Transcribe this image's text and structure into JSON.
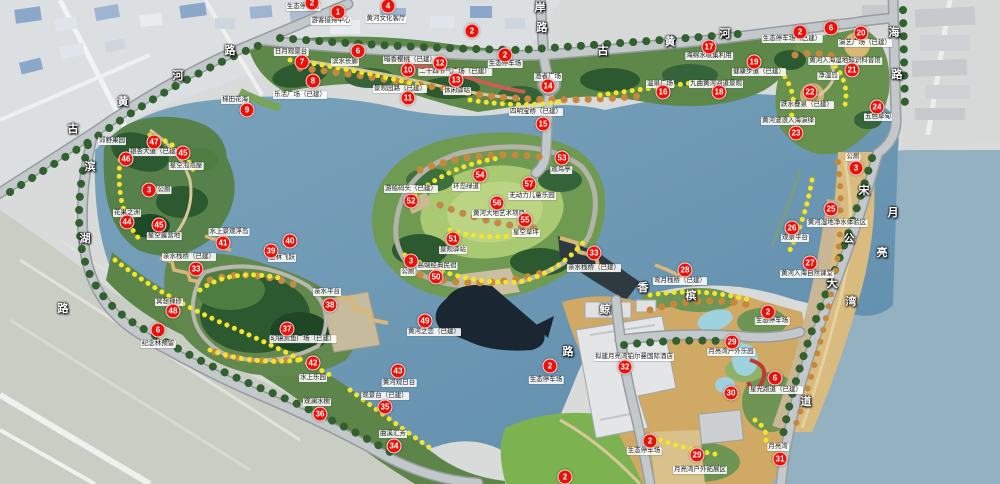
{
  "palette": {
    "water": "#6d98b4",
    "park_green": "#5e874a",
    "forest_green": "#2d5930",
    "lawn_green": "#7cb24f",
    "road_gray": "#c3c8cb",
    "resort_tan": "#d0a965",
    "beach_sand": "#dabb7f",
    "marker_red": "#e8120b",
    "flower_yellow": "#f3e42c"
  },
  "markers": [
    {
      "n": "1",
      "x": 338,
      "y": 12
    },
    {
      "n": "2",
      "x": 312,
      "y": 3
    },
    {
      "n": "4",
      "x": 388,
      "y": 6
    },
    {
      "n": "2",
      "x": 472,
      "y": 31
    },
    {
      "n": "2",
      "x": 505,
      "y": 55
    },
    {
      "n": "6",
      "x": 358,
      "y": 51
    },
    {
      "n": "7",
      "x": 302,
      "y": 62
    },
    {
      "n": "8",
      "x": 313,
      "y": 81
    },
    {
      "n": "9",
      "x": 247,
      "y": 110
    },
    {
      "n": "10",
      "x": 408,
      "y": 70
    },
    {
      "n": "12",
      "x": 440,
      "y": 63
    },
    {
      "n": "11",
      "x": 408,
      "y": 98
    },
    {
      "n": "13",
      "x": 456,
      "y": 80
    },
    {
      "n": "14",
      "x": 548,
      "y": 86
    },
    {
      "n": "15",
      "x": 543,
      "y": 124
    },
    {
      "n": "2",
      "x": 800,
      "y": 32
    },
    {
      "n": "6",
      "x": 831,
      "y": 28
    },
    {
      "n": "20",
      "x": 861,
      "y": 33
    },
    {
      "n": "21",
      "x": 852,
      "y": 70
    },
    {
      "n": "17",
      "x": 709,
      "y": 47
    },
    {
      "n": "19",
      "x": 754,
      "y": 62
    },
    {
      "n": "16",
      "x": 663,
      "y": 92
    },
    {
      "n": "18",
      "x": 719,
      "y": 92
    },
    {
      "n": "22",
      "x": 810,
      "y": 92
    },
    {
      "n": "24",
      "x": 877,
      "y": 107
    },
    {
      "n": "23",
      "x": 796,
      "y": 133
    },
    {
      "n": "3",
      "x": 856,
      "y": 168
    },
    {
      "n": "25",
      "x": 831,
      "y": 209
    },
    {
      "n": "26",
      "x": 792,
      "y": 228
    },
    {
      "n": "27",
      "x": 810,
      "y": 263
    },
    {
      "n": "28",
      "x": 685,
      "y": 270
    },
    {
      "n": "33",
      "x": 594,
      "y": 253
    },
    {
      "n": "2",
      "x": 768,
      "y": 312
    },
    {
      "n": "29",
      "x": 732,
      "y": 342
    },
    {
      "n": "32",
      "x": 625,
      "y": 367
    },
    {
      "n": "6",
      "x": 775,
      "y": 378
    },
    {
      "n": "30",
      "x": 731,
      "y": 393
    },
    {
      "n": "2",
      "x": 550,
      "y": 366
    },
    {
      "n": "2",
      "x": 650,
      "y": 441
    },
    {
      "n": "29",
      "x": 697,
      "y": 455
    },
    {
      "n": "31",
      "x": 780,
      "y": 459
    },
    {
      "n": "2",
      "x": 565,
      "y": 477
    },
    {
      "n": "53",
      "x": 562,
      "y": 158
    },
    {
      "n": "54",
      "x": 480,
      "y": 175
    },
    {
      "n": "57",
      "x": 529,
      "y": 184
    },
    {
      "n": "56",
      "x": 497,
      "y": 203
    },
    {
      "n": "55",
      "x": 525,
      "y": 220
    },
    {
      "n": "52",
      "x": 411,
      "y": 201
    },
    {
      "n": "51",
      "x": 453,
      "y": 239
    },
    {
      "n": "3",
      "x": 411,
      "y": 261
    },
    {
      "n": "50",
      "x": 436,
      "y": 277
    },
    {
      "n": "49",
      "x": 425,
      "y": 321
    },
    {
      "n": "47",
      "x": 154,
      "y": 142
    },
    {
      "n": "45",
      "x": 183,
      "y": 153
    },
    {
      "n": "46",
      "x": 126,
      "y": 159
    },
    {
      "n": "3",
      "x": 149,
      "y": 190
    },
    {
      "n": "44",
      "x": 127,
      "y": 222
    },
    {
      "n": "45",
      "x": 159,
      "y": 225
    },
    {
      "n": "41",
      "x": 223,
      "y": 243
    },
    {
      "n": "40",
      "x": 290,
      "y": 241
    },
    {
      "n": "39",
      "x": 271,
      "y": 251
    },
    {
      "n": "33",
      "x": 196,
      "y": 269
    },
    {
      "n": "48",
      "x": 173,
      "y": 311
    },
    {
      "n": "6",
      "x": 158,
      "y": 330
    },
    {
      "n": "38",
      "x": 330,
      "y": 305
    },
    {
      "n": "37",
      "x": 287,
      "y": 329
    },
    {
      "n": "42",
      "x": 313,
      "y": 363
    },
    {
      "n": "43",
      "x": 398,
      "y": 371
    },
    {
      "n": "35",
      "x": 385,
      "y": 407
    },
    {
      "n": "36",
      "x": 320,
      "y": 414
    },
    {
      "n": "34",
      "x": 394,
      "y": 446
    }
  ],
  "labels": [
    {
      "text": "生态停车场",
      "x": 303,
      "y": 7
    },
    {
      "text": "游客接待中心",
      "x": 331,
      "y": 21
    },
    {
      "text": "黄河文化客厅",
      "x": 386,
      "y": 19
    },
    {
      "text": "滨水长廊",
      "x": 345,
      "y": 62
    },
    {
      "text": "日月观景台",
      "x": 291,
      "y": 52
    },
    {
      "text": "乐活广场（已建）",
      "x": 300,
      "y": 95
    },
    {
      "text": "梯田花海",
      "x": 235,
      "y": 100
    },
    {
      "text": "暗香樱桃（已建）",
      "x": 410,
      "y": 60
    },
    {
      "text": "二十四节气广场（已建）",
      "x": 455,
      "y": 72
    },
    {
      "text": "景观园路（已建）",
      "x": 400,
      "y": 89
    },
    {
      "text": "休闲驿站",
      "x": 457,
      "y": 91
    },
    {
      "text": "生态停车场",
      "x": 505,
      "y": 64
    },
    {
      "text": "渔者广场",
      "x": 548,
      "y": 77
    },
    {
      "text": "四明宝桥（已建）",
      "x": 536,
      "y": 112
    },
    {
      "text": "生态停车场（已建）",
      "x": 792,
      "y": 39
    },
    {
      "text": "演艺广场（已建）",
      "x": 865,
      "y": 43
    },
    {
      "text": "黄河入海湿地知识科普馆",
      "x": 845,
      "y": 61
    },
    {
      "text": "净湿岛",
      "x": 828,
      "y": 76
    },
    {
      "text": "海绵水收集利用",
      "x": 709,
      "y": 56
    },
    {
      "text": "健康步道（已建）",
      "x": 759,
      "y": 72
    },
    {
      "text": "温泉广场",
      "x": 660,
      "y": 84
    },
    {
      "text": "九曲黄河河道景观",
      "x": 716,
      "y": 84
    },
    {
      "text": "跌水叠泉（已建）",
      "x": 807,
      "y": 105
    },
    {
      "text": "五色草甸",
      "x": 878,
      "y": 117
    },
    {
      "text": "黄河波浪入海演绎",
      "x": 788,
      "y": 121
    },
    {
      "text": "公厕",
      "x": 853,
      "y": 157
    },
    {
      "text": "黄河湿地净水体验区",
      "x": 837,
      "y": 223
    },
    {
      "text": "观景平台",
      "x": 795,
      "y": 238
    },
    {
      "text": "黄河入海自然课堂",
      "x": 807,
      "y": 274
    },
    {
      "text": "弯月栈桥（已建）",
      "x": 680,
      "y": 281
    },
    {
      "text": "郊野果园",
      "x": 112,
      "y": 141
    },
    {
      "text": "银杏大道（已建）",
      "x": 156,
      "y": 152
    },
    {
      "text": "星空泡泡屋",
      "x": 186,
      "y": 166
    },
    {
      "text": "公厕",
      "x": 164,
      "y": 190
    },
    {
      "text": "花果之洲",
      "x": 127,
      "y": 213
    },
    {
      "text": "星空露营地",
      "x": 164,
      "y": 236
    },
    {
      "text": "水上景观浮岛",
      "x": 229,
      "y": 232
    },
    {
      "text": "丛林飞跃",
      "x": 282,
      "y": 258
    },
    {
      "text": "亲水栈桥（已建）",
      "x": 189,
      "y": 257
    },
    {
      "text": "冥想禅修",
      "x": 169,
      "y": 302
    },
    {
      "text": "纪念林预留",
      "x": 158,
      "y": 344
    },
    {
      "text": "游船码头（已建）",
      "x": 411,
      "y": 189
    },
    {
      "text": "环岛绿道",
      "x": 466,
      "y": 187
    },
    {
      "text": "观鸟亭",
      "x": 561,
      "y": 170
    },
    {
      "text": "无动力儿童乐园",
      "x": 532,
      "y": 196
    },
    {
      "text": "黄河大地艺术项目",
      "x": 499,
      "y": 214
    },
    {
      "text": "星空草坪",
      "x": 526,
      "y": 233
    },
    {
      "text": "景观驿站",
      "x": 453,
      "y": 250
    },
    {
      "text": "公厕",
      "x": 408,
      "y": 272
    },
    {
      "text": "高端经典民宿",
      "x": 437,
      "y": 266
    },
    {
      "text": "黄河之恋（已建）",
      "x": 434,
      "y": 332
    },
    {
      "text": "亲水平台",
      "x": 327,
      "y": 292
    },
    {
      "text": "幻镜赏鱼广场（已建）",
      "x": 303,
      "y": 339
    },
    {
      "text": "水上乐园",
      "x": 313,
      "y": 378
    },
    {
      "text": "观澜水榭",
      "x": 317,
      "y": 402
    },
    {
      "text": "观景台（已建）",
      "x": 385,
      "y": 396
    },
    {
      "text": "曲溪汇芳",
      "x": 393,
      "y": 434
    },
    {
      "text": "黄河观日台",
      "x": 399,
      "y": 383
    },
    {
      "text": "亲水栈桥（已建）",
      "x": 594,
      "y": 268
    },
    {
      "text": "生态停车场",
      "x": 546,
      "y": 380
    },
    {
      "text": "拟建月亮湾铂尔曼国际酒店",
      "x": 634,
      "y": 357
    },
    {
      "text": "生态停车场",
      "x": 644,
      "y": 451
    },
    {
      "text": "月亮湾户外拓展区",
      "x": 700,
      "y": 470
    },
    {
      "text": "月亮湾",
      "x": 778,
      "y": 447
    },
    {
      "text": "月亮湾户外乐园",
      "x": 731,
      "y": 352
    },
    {
      "text": "生态停车场",
      "x": 772,
      "y": 321
    },
    {
      "text": "星光跑道（已建）",
      "x": 776,
      "y": 390
    }
  ],
  "road_chars": [
    {
      "ch": "黄",
      "x": 123,
      "y": 101
    },
    {
      "ch": "河",
      "x": 178,
      "y": 75
    },
    {
      "ch": "路",
      "x": 230,
      "y": 50
    },
    {
      "ch": "古",
      "x": 73,
      "y": 128
    },
    {
      "ch": "滨",
      "x": 90,
      "y": 166
    },
    {
      "ch": "湖",
      "x": 85,
      "y": 238
    },
    {
      "ch": "路",
      "x": 63,
      "y": 308
    },
    {
      "ch": "岸",
      "x": 540,
      "y": 7
    },
    {
      "ch": "路",
      "x": 542,
      "y": 27
    },
    {
      "ch": "古",
      "x": 603,
      "y": 50
    },
    {
      "ch": "黄",
      "x": 670,
      "y": 41
    },
    {
      "ch": "河",
      "x": 725,
      "y": 33
    },
    {
      "ch": "海",
      "x": 894,
      "y": 32
    },
    {
      "ch": "路",
      "x": 897,
      "y": 74
    },
    {
      "ch": "宋",
      "x": 864,
      "y": 190
    },
    {
      "ch": "公",
      "x": 849,
      "y": 238
    },
    {
      "ch": "大",
      "x": 832,
      "y": 283
    },
    {
      "ch": "道",
      "x": 806,
      "y": 401
    },
    {
      "ch": "月",
      "x": 893,
      "y": 212
    },
    {
      "ch": "亮",
      "x": 882,
      "y": 252
    },
    {
      "ch": "湾",
      "x": 851,
      "y": 301
    },
    {
      "ch": "香",
      "x": 643,
      "y": 287
    },
    {
      "ch": "槟",
      "x": 691,
      "y": 295
    },
    {
      "ch": "鲸",
      "x": 605,
      "y": 309
    },
    {
      "ch": "路",
      "x": 568,
      "y": 351
    }
  ]
}
